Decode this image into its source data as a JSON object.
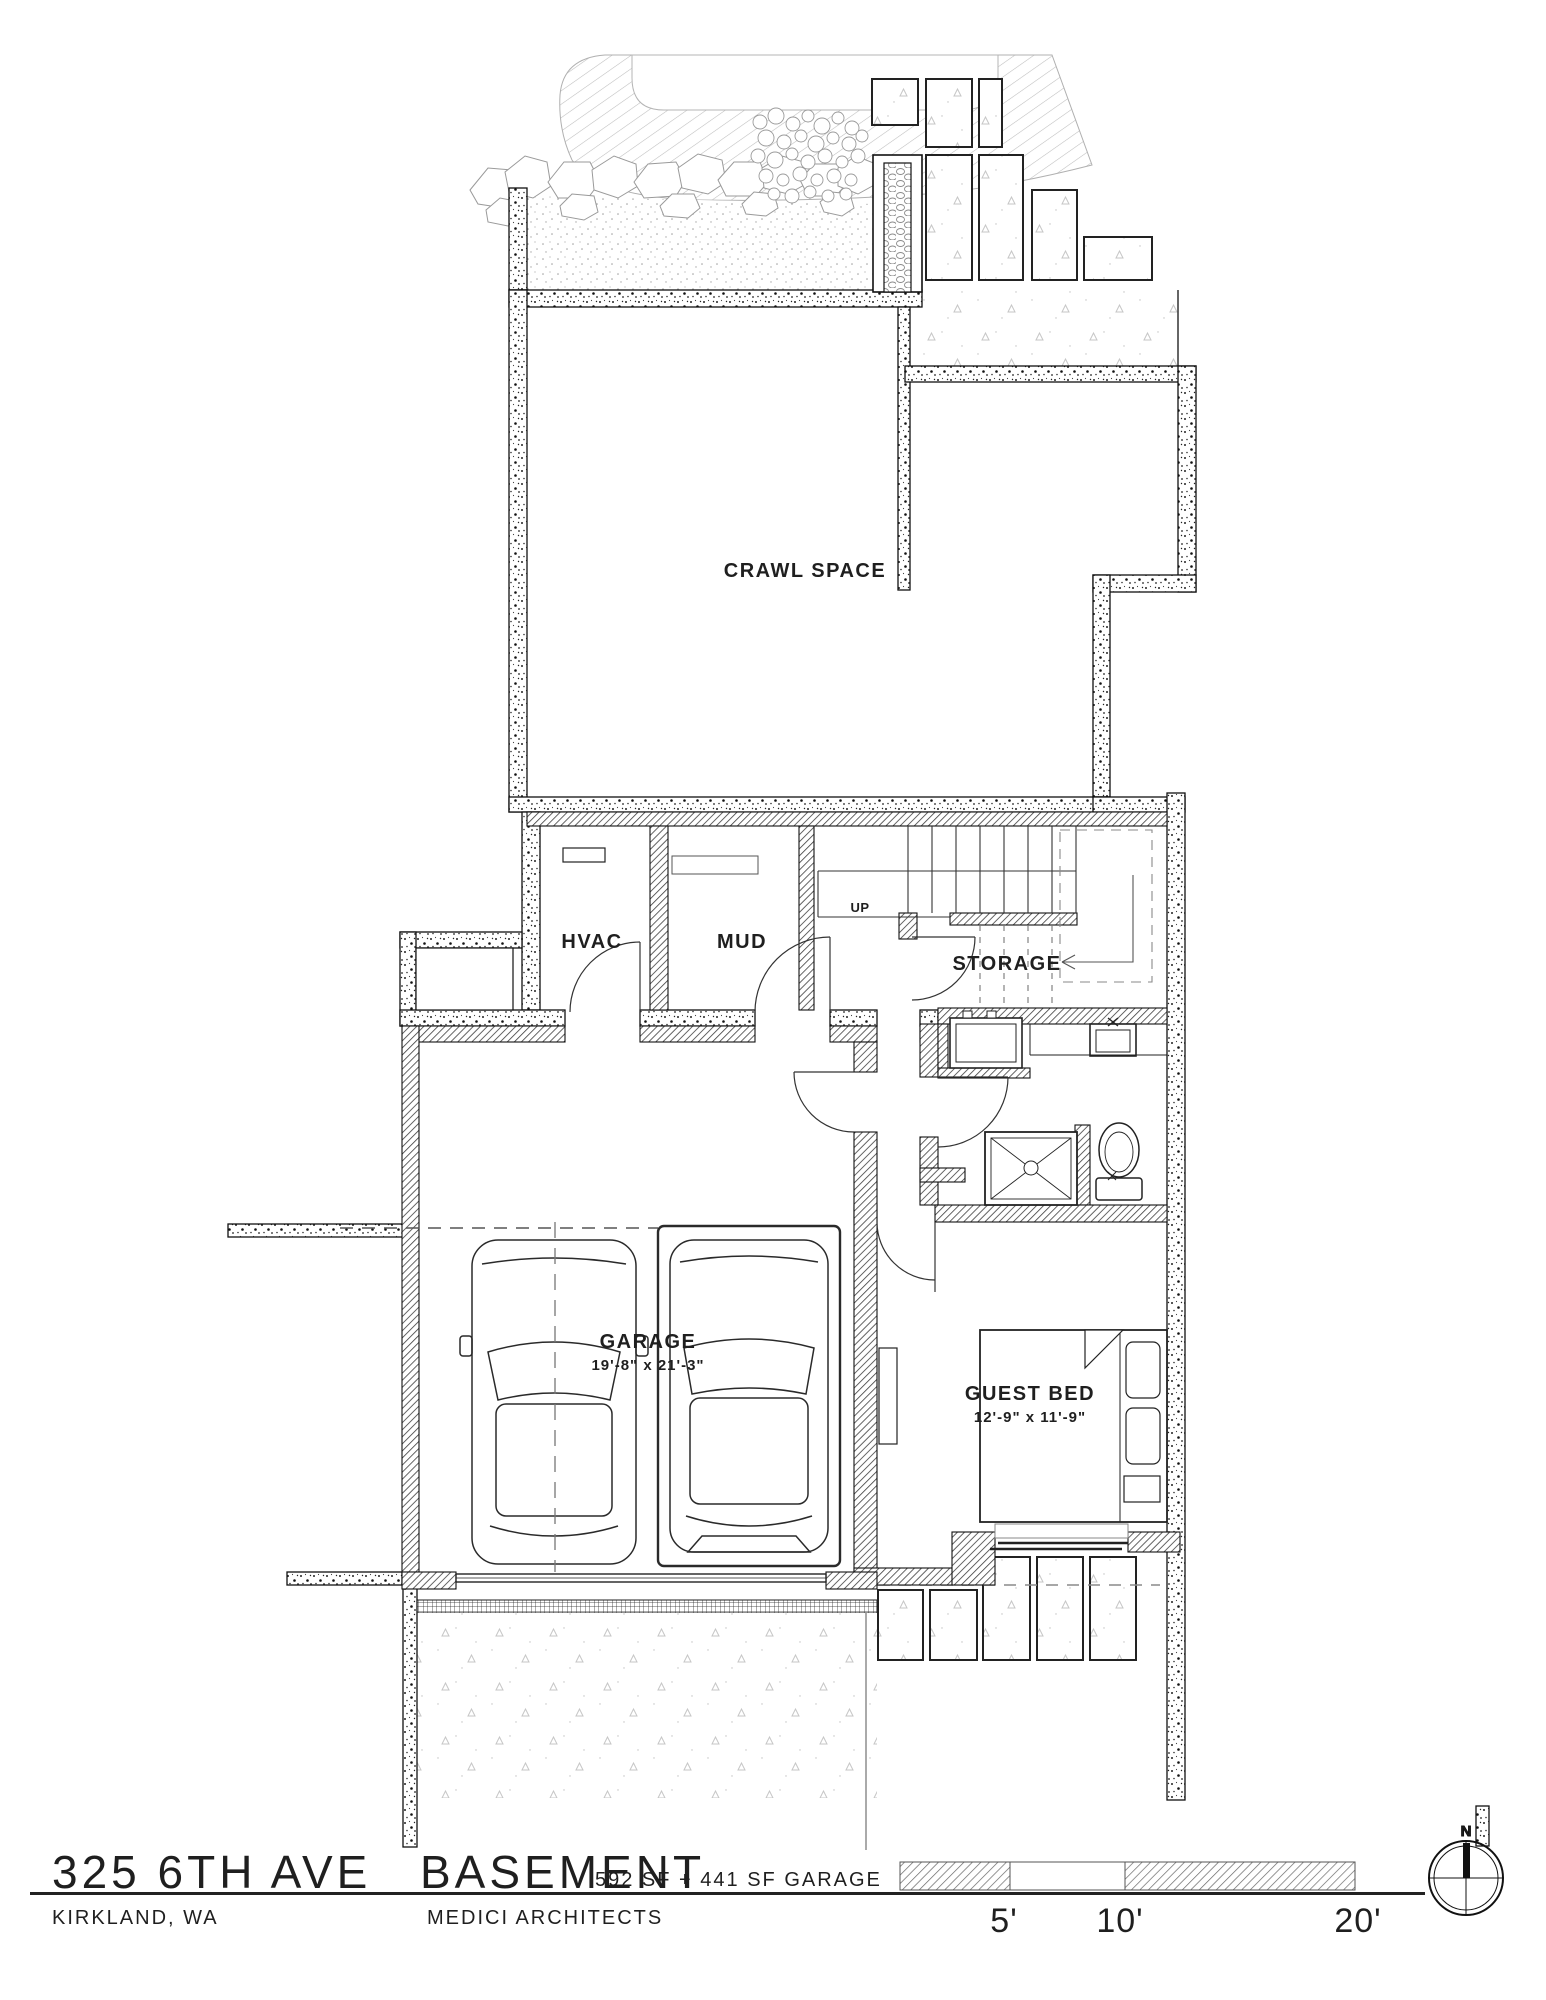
{
  "plan": {
    "rooms": {
      "crawl_space": {
        "label": "CRAWL SPACE"
      },
      "hvac": {
        "label": "HVAC"
      },
      "mud": {
        "label": "MUD"
      },
      "storage": {
        "label": "STORAGE"
      },
      "garage": {
        "label": "GARAGE",
        "dimensions": "19'-8\" x 21'-3\""
      },
      "guest_bed": {
        "label": "GUEST BED",
        "dimensions": "12'-9\" x 11'-9\""
      }
    },
    "annotations": {
      "stair_direction": "UP"
    }
  },
  "title_block": {
    "address": "325 6TH AVE",
    "city": "KIRKLAND, WA",
    "sheet_name": "BASEMENT",
    "area_note": "592 SF + 441 SF GARAGE",
    "firm": "MEDICI ARCHITECTS"
  },
  "scale_bar": {
    "labels": [
      "5'",
      "10'",
      "20'"
    ]
  },
  "compass": {
    "north_label": "N"
  },
  "colors": {
    "line": "#1a1a1a",
    "gray_line": "#9a9a9a",
    "wall_hatch": "#3d3d3d"
  }
}
